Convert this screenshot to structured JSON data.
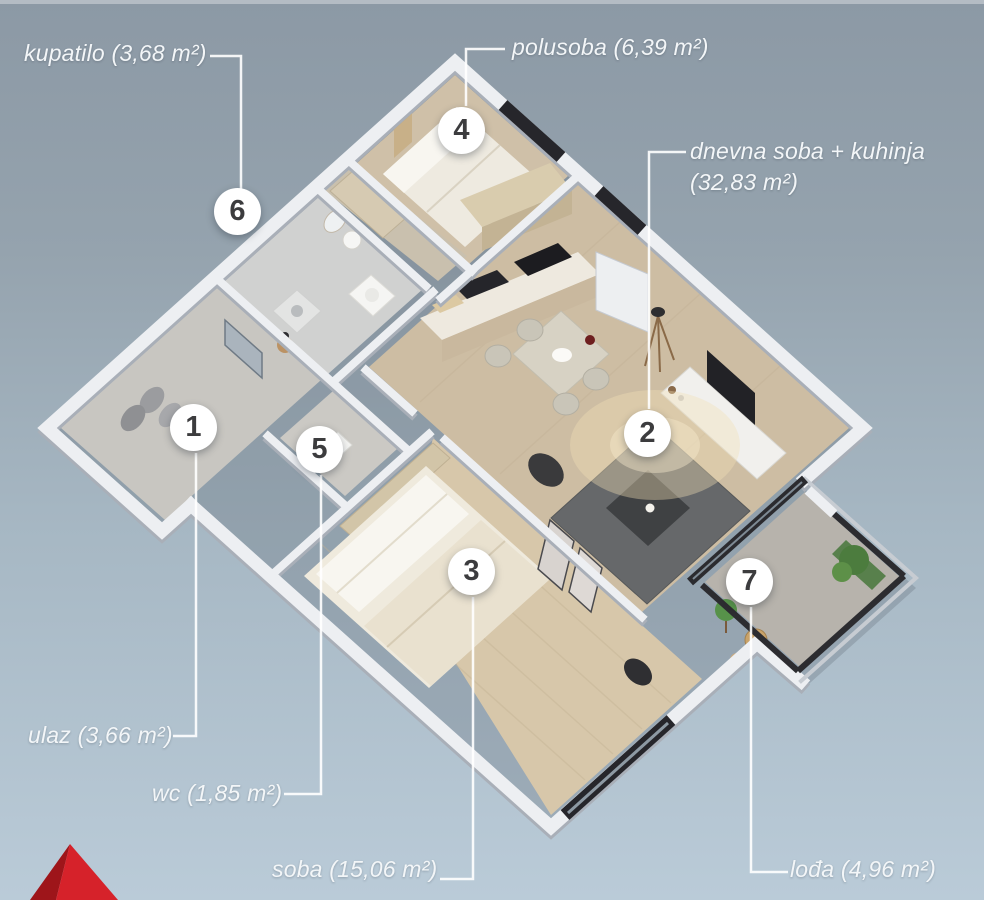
{
  "scene_title": "3D apartment floor plan",
  "rooms": [
    {
      "number": "1",
      "label": "ulaz (3,66 m²)"
    },
    {
      "number": "2",
      "label": "dnevna soba + kuhinja (32,83 m²)"
    },
    {
      "number": "3",
      "label": "soba (15,06 m²)"
    },
    {
      "number": "4",
      "label": "polusoba (6,39 m²)"
    },
    {
      "number": "5",
      "label": "wc (1,85 m²)"
    },
    {
      "number": "6",
      "label": "kupatilo (3,68 m²)"
    },
    {
      "number": "7",
      "label": "lođa (4,96 m²)"
    }
  ],
  "colors": {
    "background_top": "#8c99a5",
    "background_bottom": "#bacbd8",
    "label_text": "#f3f6f8",
    "leader_line": "#ffffff",
    "marker_background": "#ffffff",
    "marker_number": "#3c3c3e",
    "wall_white": "#edeff2",
    "window_frame": "#26262b",
    "wood_floor": "#cdbda3",
    "logo_red": "#d6222a"
  },
  "logo": {
    "icon": "red-pyramid-logo"
  }
}
